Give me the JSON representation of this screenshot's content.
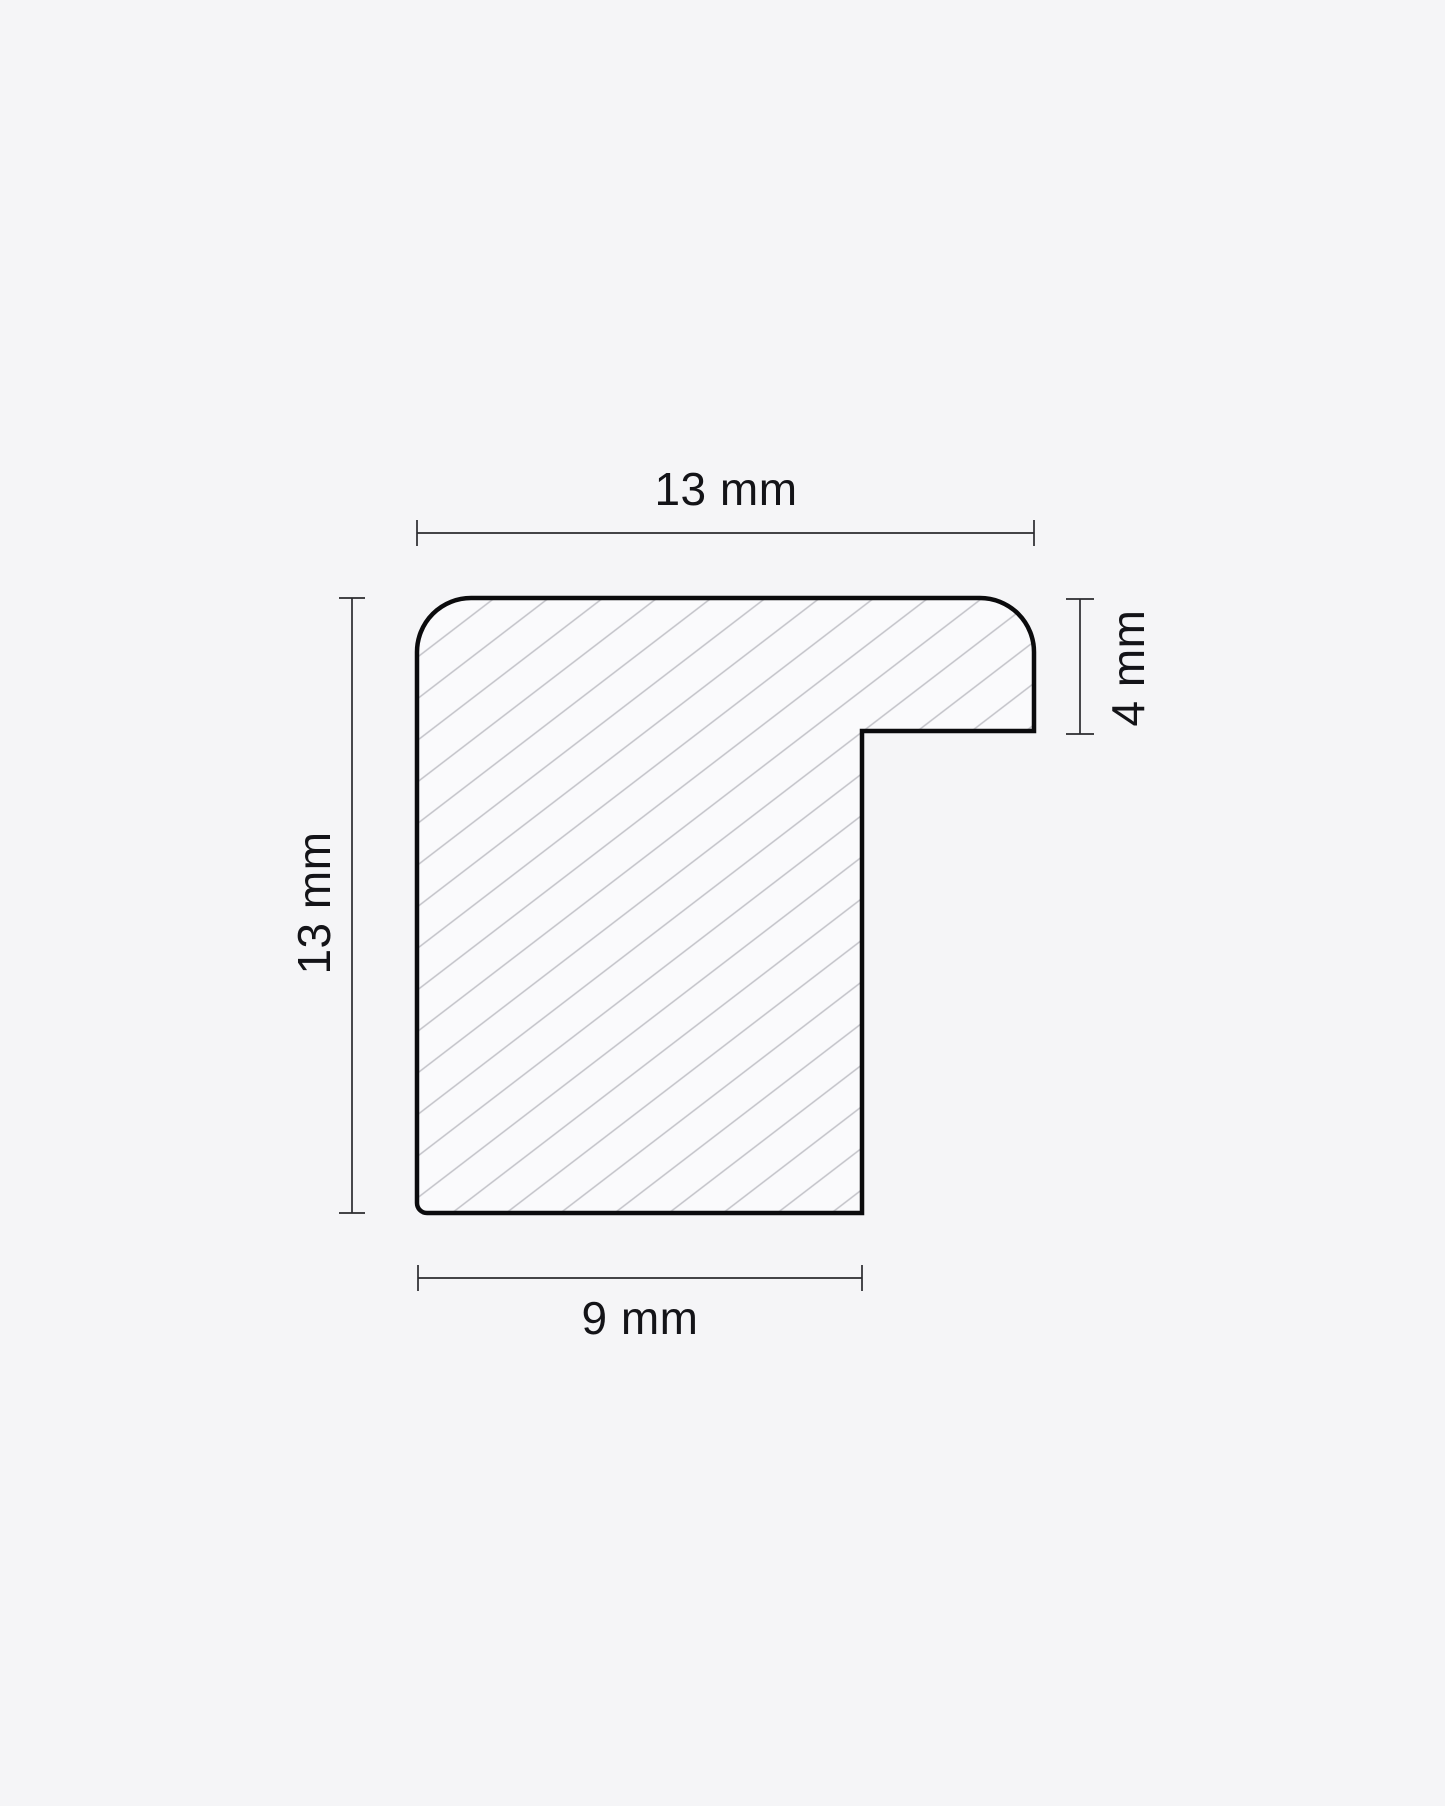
{
  "diagram": {
    "title": "picture-frame moulding cross-section",
    "type": "technical-drawing",
    "unit": "mm",
    "colors": {
      "background": "#f5f5f7",
      "outline": "#0b0b0d",
      "fill": "#fafafc",
      "hatch": "#c2c2c8",
      "dimension": "#2a2a2e",
      "text": "#141418"
    },
    "dimensions": {
      "top": {
        "label": "13 mm",
        "value": 13,
        "unit": "mm",
        "measures": "overall profile width"
      },
      "left": {
        "label": "13 mm",
        "value": 13,
        "unit": "mm",
        "measures": "overall profile height"
      },
      "right": {
        "label": "4 mm",
        "value": 4,
        "unit": "mm",
        "measures": "rabbet lip depth"
      },
      "bottom": {
        "label": "9 mm",
        "value": 9,
        "unit": "mm",
        "measures": "base width"
      }
    }
  }
}
